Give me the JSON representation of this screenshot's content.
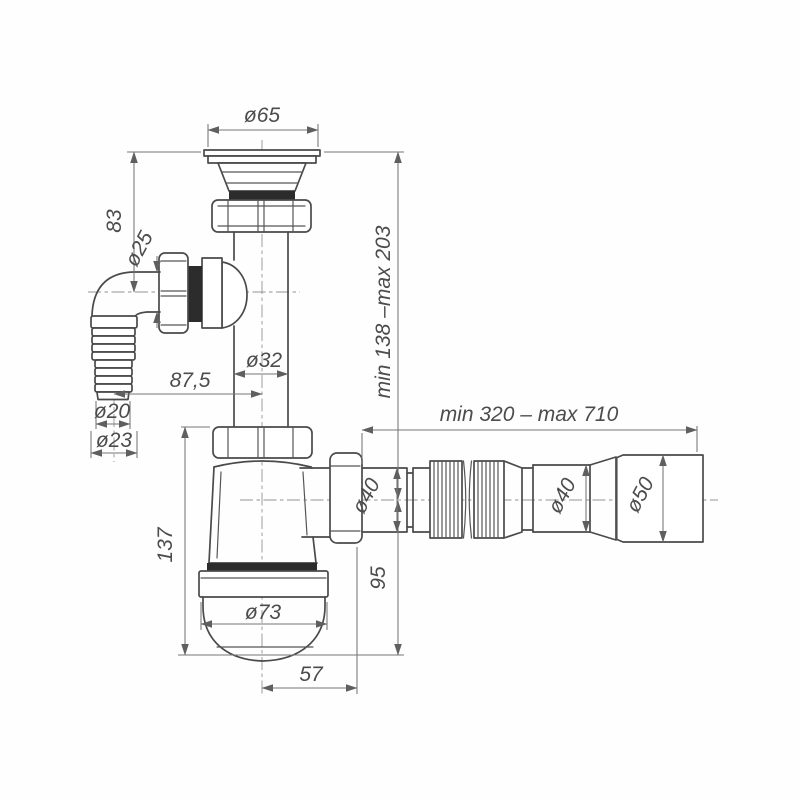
{
  "drawing": {
    "subject": "bottle-trap siphon with corrugated flexible outlet hose, dimensioned technical drawing",
    "labels": {
      "flange_diameter": "ø65",
      "inlet_height": "83",
      "inlet_nut_diameter": "ø25",
      "pipe_diameter": "ø32",
      "inlet_offset": "87,5",
      "height_range": "min 138 –max 203",
      "hose_tip_diameter": "ø20",
      "hose_barb_diameter": "ø23",
      "body_height": "137",
      "cup_diameter": "ø73",
      "outlet_offset": "57",
      "outlet_drop": "95",
      "length_range": "min 320 – max 710",
      "outlet_pipe_diameter": "ø40",
      "hose_pipe_diameter": "ø40",
      "hose_end_diameter": "ø50"
    }
  }
}
